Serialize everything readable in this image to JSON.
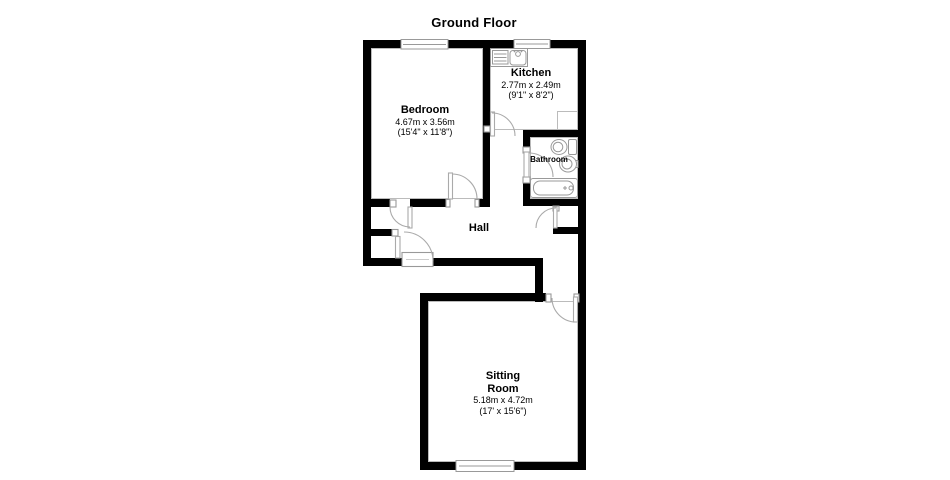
{
  "title": "Ground Floor",
  "rooms": {
    "bedroom": {
      "name": "Bedroom",
      "dim_metric": "4.67m x 3.56m",
      "dim_imperial": "(15'4\" x 11'8\")"
    },
    "kitchen": {
      "name": "Kitchen",
      "dim_metric": "2.77m x 2.49m",
      "dim_imperial": "(9'1\" x 8'2\")"
    },
    "bathroom": {
      "name": "Bathroom"
    },
    "hall": {
      "name": "Hall"
    },
    "sitting_room": {
      "name": "Sitting\nRoom",
      "dim_metric": "5.18m x 4.72m",
      "dim_imperial": "(17' x 15'6\")"
    }
  },
  "colors": {
    "wall": "#000000",
    "room_outline": "#bbbbbb",
    "fixture_outline": "#999999",
    "door_arc": "#aaaaaa",
    "background": "#ffffff"
  }
}
